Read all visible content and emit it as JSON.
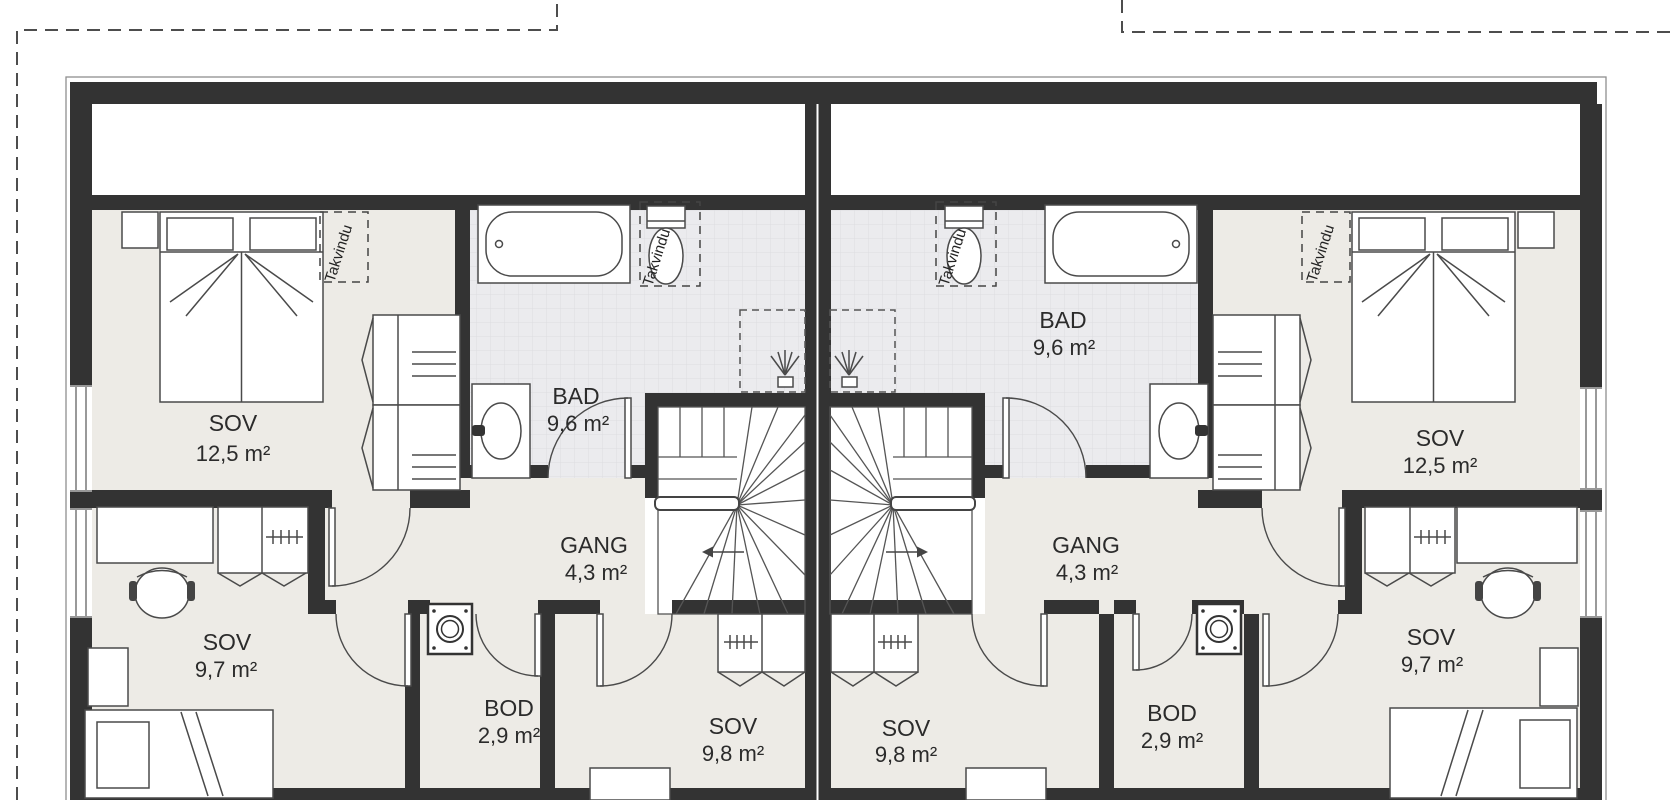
{
  "plan": {
    "title": "Duplex upper floor plan",
    "takvindu_label": "Takvindu",
    "colors": {
      "wall": "#333333",
      "floor": "#edebe6",
      "bath_floor": "#ebebee",
      "boundary": "#4d4d4d",
      "furniture_stroke": "#4a4a4a"
    },
    "units": [
      {
        "side": "left",
        "rooms": [
          {
            "name": "SOV",
            "area": "12,5 m²"
          },
          {
            "name": "BAD",
            "area": "9,6 m²"
          },
          {
            "name": "GANG",
            "area": "4,3 m²"
          },
          {
            "name": "SOV",
            "area": "9,7 m²"
          },
          {
            "name": "BOD",
            "area": "2,9 m²"
          },
          {
            "name": "SOV",
            "area": "9,8 m²"
          }
        ]
      },
      {
        "side": "right",
        "rooms": [
          {
            "name": "BAD",
            "area": "9,6 m²"
          },
          {
            "name": "SOV",
            "area": "12,5 m²"
          },
          {
            "name": "GANG",
            "area": "4,3 m²"
          },
          {
            "name": "SOV",
            "area": "9,8 m²"
          },
          {
            "name": "BOD",
            "area": "2,9 m²"
          },
          {
            "name": "SOV",
            "area": "9,7 m²"
          }
        ]
      }
    ]
  }
}
